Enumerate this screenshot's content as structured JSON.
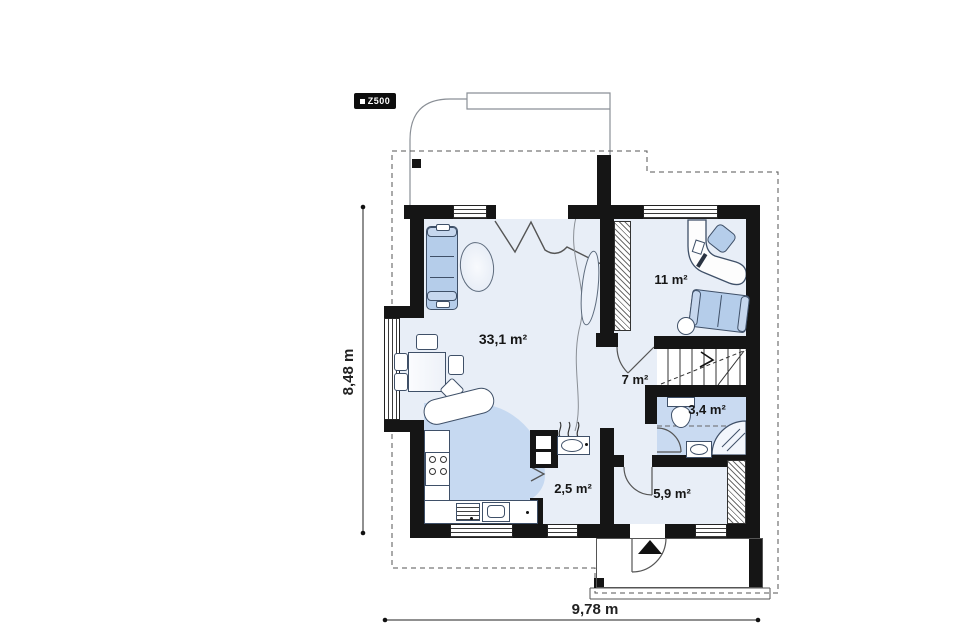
{
  "brand": {
    "logo_label": "Z500"
  },
  "plan": {
    "rooms": [
      {
        "id": "living-dining",
        "area_label": "33,1 m²"
      },
      {
        "id": "office",
        "area_label": "11 m²"
      },
      {
        "id": "hall",
        "area_label": "7 m²"
      },
      {
        "id": "bathroom",
        "area_label": "3,4 m²"
      },
      {
        "id": "utility",
        "area_label": "2,5 m²"
      },
      {
        "id": "entry",
        "area_label": "5,9 m²"
      }
    ],
    "dimensions": {
      "vertical_label": "8,48 m",
      "horizontal_label": "9,78 m"
    },
    "colors": {
      "wall": "#151515",
      "floor": "#e8eef7",
      "floor_accent": "#c6d9f1",
      "furniture": "#b5cdea",
      "background": "#ffffff"
    }
  }
}
